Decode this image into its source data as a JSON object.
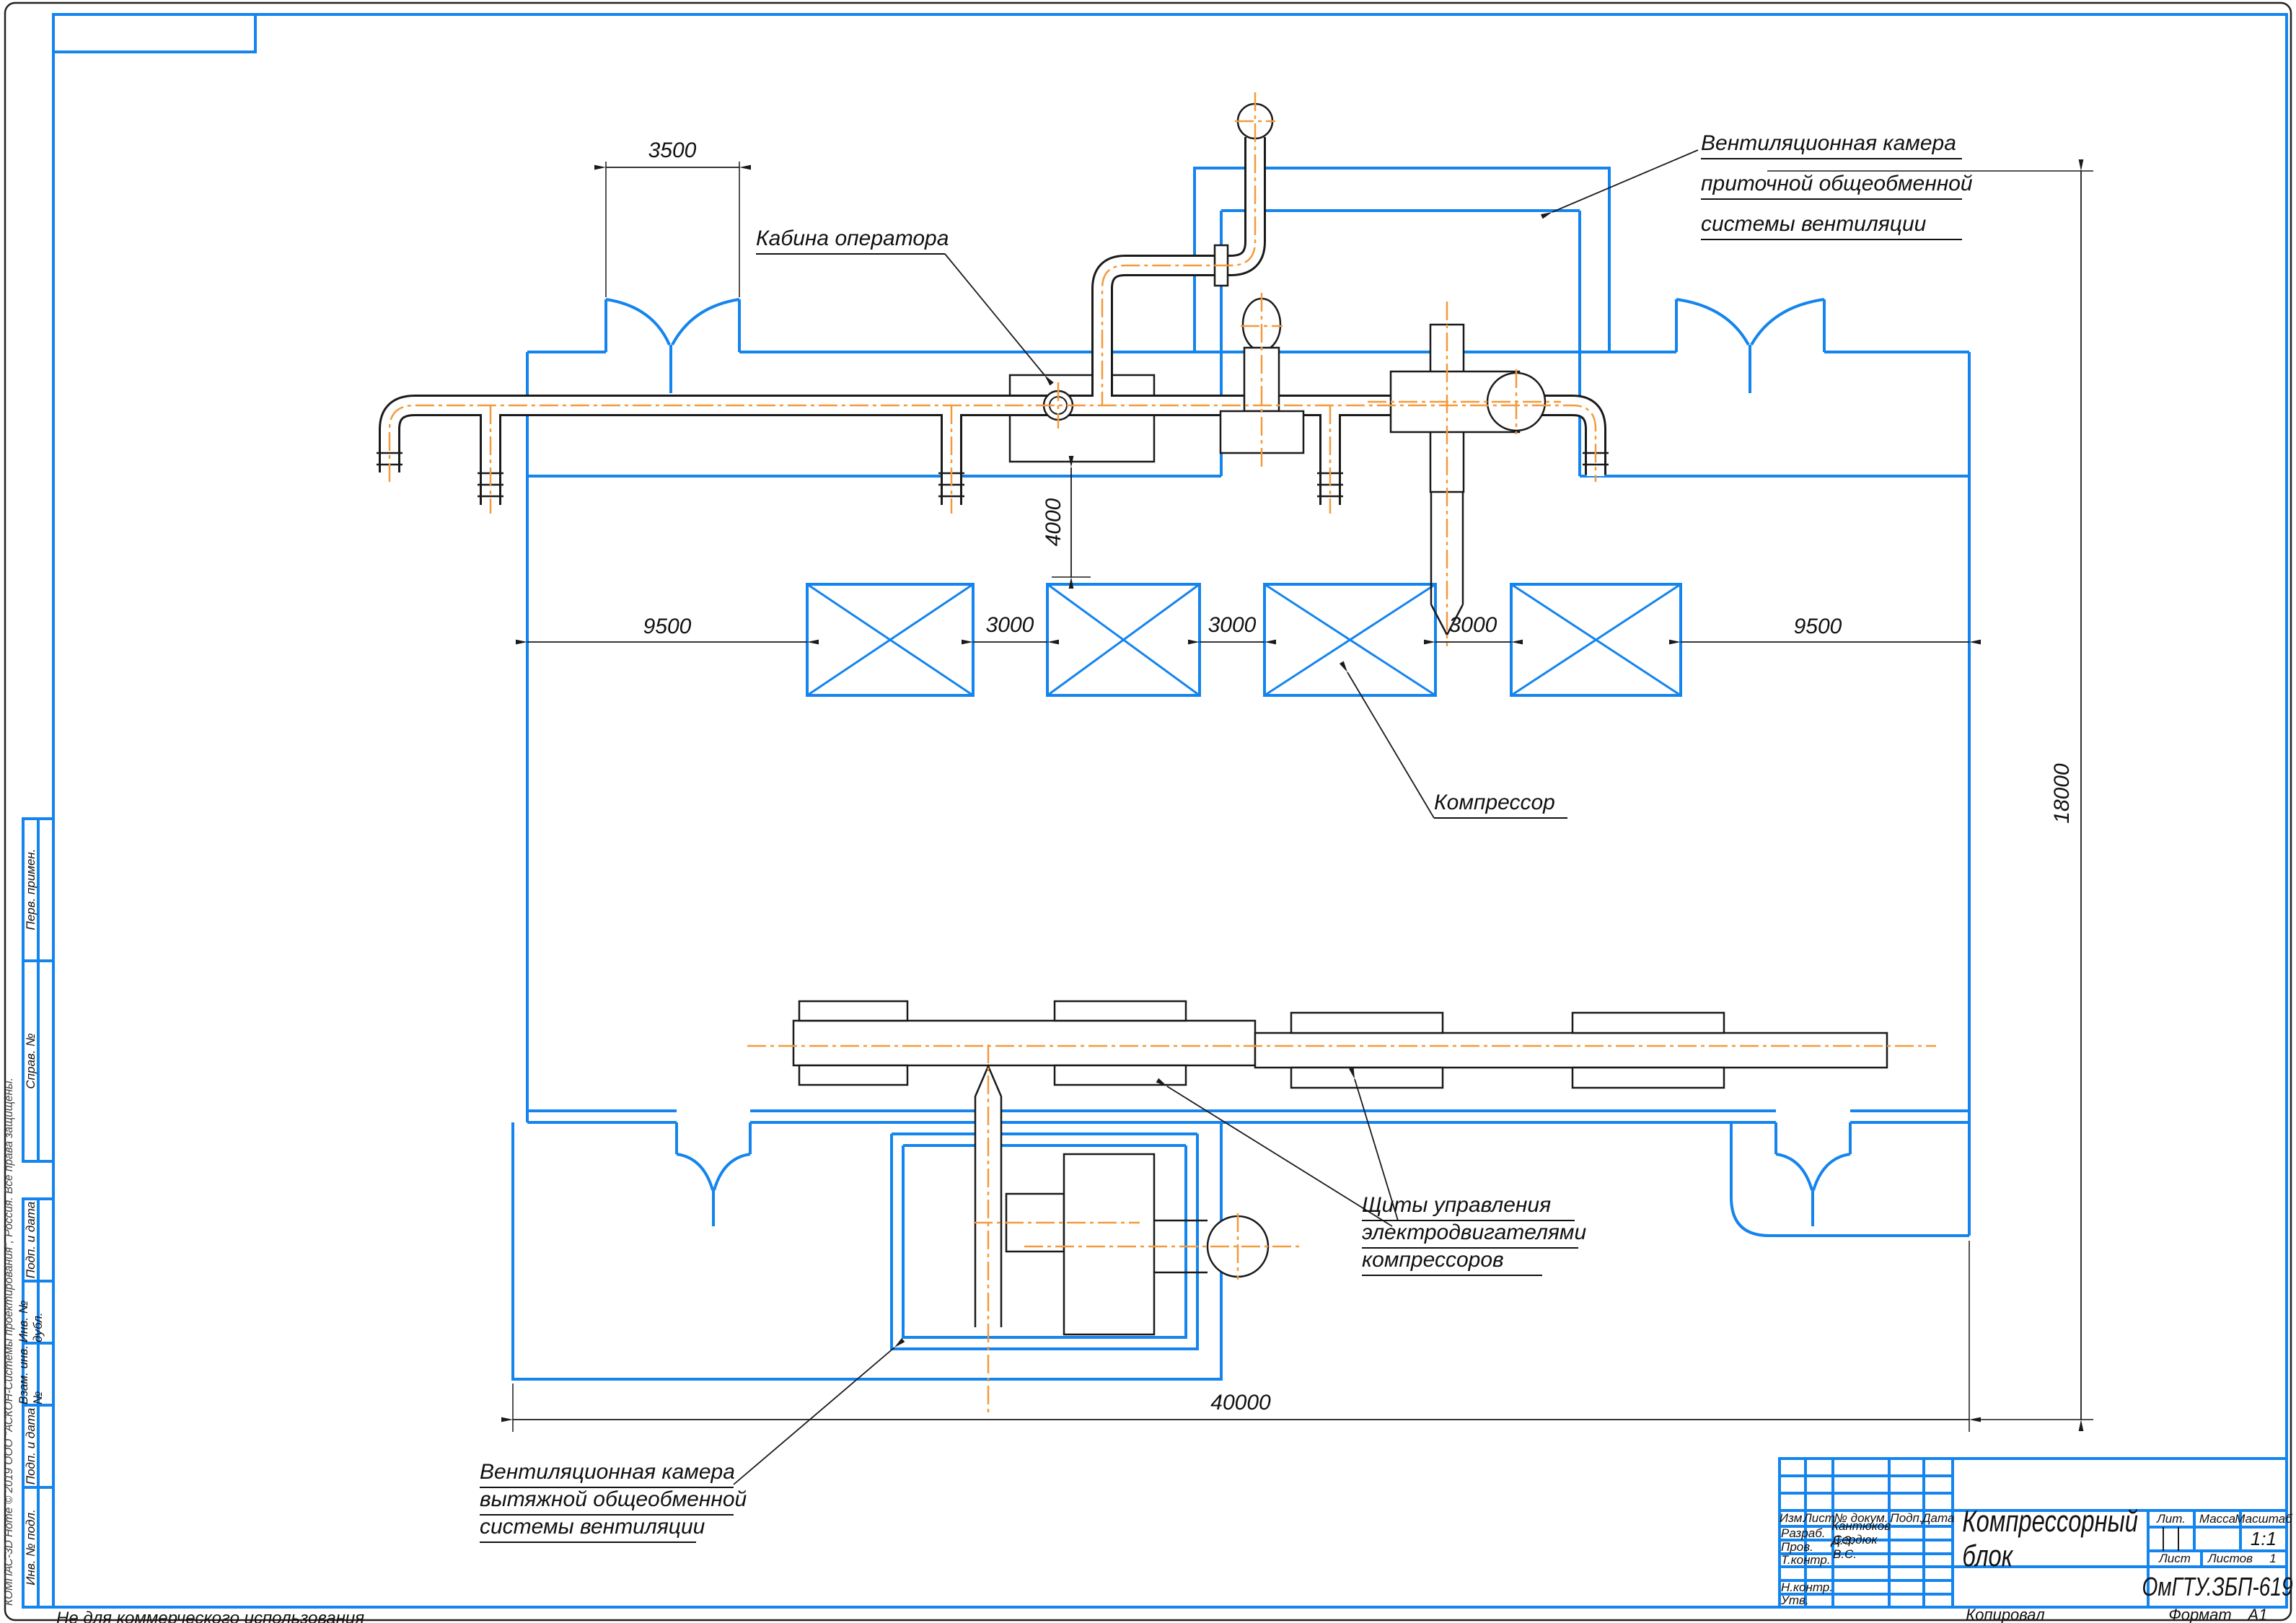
{
  "colors": {
    "frame_blue": "#1484ee",
    "pipe_orange": "#f49a3c",
    "line_black": "#1a1a1a"
  },
  "sheet": {
    "watermark": "КОМПАС-3D Home © 2019 ООО \"АСКОН-Системы проектирования\", Россия. Все права защищены.",
    "not_for_commercial": "Не для коммерческого использования",
    "copied_label": "Копировал",
    "format_label": "Формат",
    "format_value": "А1"
  },
  "side_column": {
    "cells": [
      "Перв. примен.",
      "Справ. №",
      "Подп. и дата",
      "Инв. № дубл.",
      "Взам. инв. №",
      "Подп. и дата",
      "Инв. № подл."
    ]
  },
  "title_block": {
    "header_cols": [
      "Изм.",
      "Лист",
      "№ докум.",
      "Подп.",
      "Дата"
    ],
    "rows": [
      {
        "label": "Разраб.",
        "value": "Кантюков Д.З."
      },
      {
        "label": "Пров.",
        "value": "Сердюк В.С."
      },
      {
        "label": "Т.контр.",
        "value": ""
      },
      {
        "label": "",
        "value": ""
      },
      {
        "label": "Н.контр.",
        "value": ""
      },
      {
        "label": "Утв.",
        "value": ""
      }
    ],
    "doc_title": "Компрессорный блок",
    "doc_code": "ОмГТУ.ЗБП-619",
    "lit_label": "Лит.",
    "mass_label": "Масса",
    "scale_label": "Масштаб",
    "scale_value": "1:1",
    "sheet_label": "Лист",
    "sheets_label": "Листов",
    "sheets_value": "1"
  },
  "annotations": {
    "operator_cabin": "Кабина оператора",
    "supply_vent": [
      "Вентиляционная камера",
      "приточной общеобменной",
      "системы вентиляции"
    ],
    "exhaust_vent": [
      "Вентиляционная камера",
      "вытяжной общеобменной",
      "системы вентиляции"
    ],
    "compressor": "Компрессор",
    "panels": [
      "Щиты управления",
      "электродвигателями",
      "компрессоров"
    ]
  },
  "dimensions": {
    "d3500": "3500",
    "d9500": "9500",
    "d3000": "3000",
    "d4000": "4000",
    "d18000": "18000",
    "d40000": "40000"
  }
}
